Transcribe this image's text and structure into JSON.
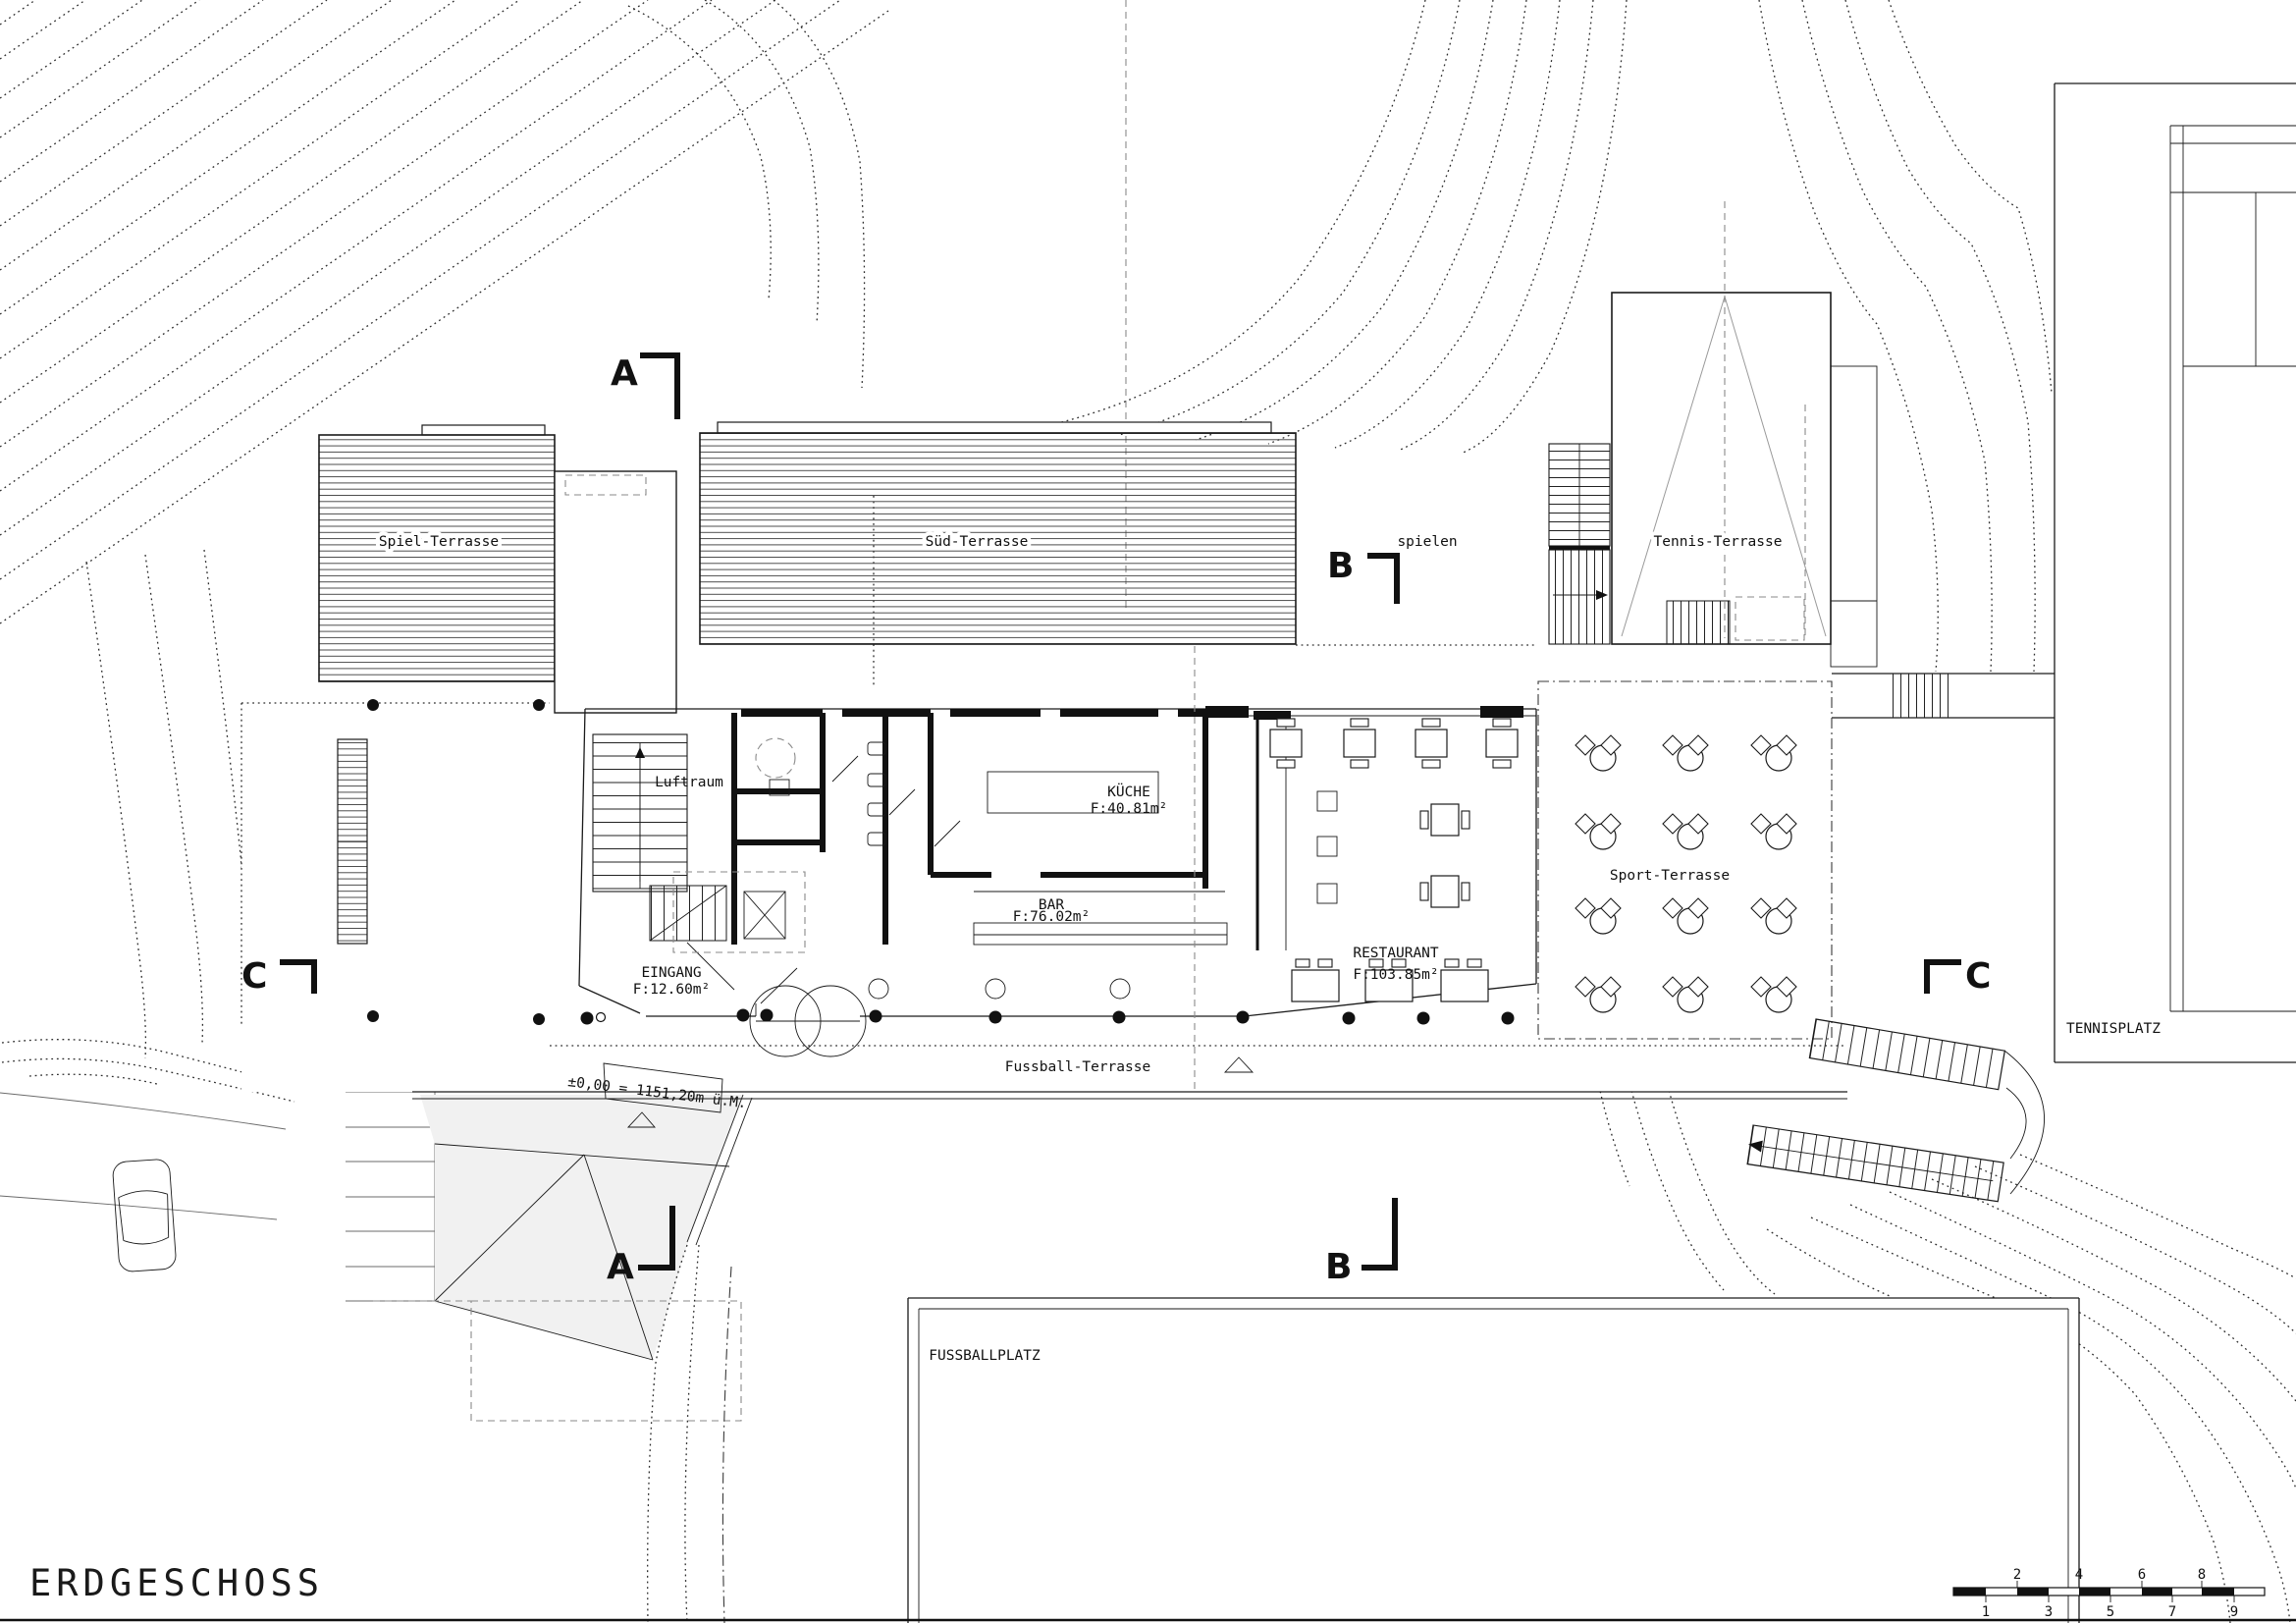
{
  "title": "ERDGESCHOSS",
  "colors": {
    "line": "#1a1a1a",
    "light_fill": "#f1f1f1",
    "hatch": "#3a3a3a"
  },
  "plan": {
    "areas": {
      "spiel_terrasse": "Spiel-Terrasse",
      "sued_terrasse": "Süd-Terrasse",
      "tennis_terrasse": "Tennis-Terrasse",
      "sport_terrasse": "Sport-Terrasse",
      "fussball_terrasse": "Fussball-Terrasse",
      "spielen": "spielen",
      "luftraum": "Luftraum",
      "fussballplatz": "FUSSBALLPLATZ",
      "tennisplatz": "TENNISPLATZ"
    },
    "rooms": {
      "kueche": {
        "name": "KÜCHE",
        "area": "F:40.81m²"
      },
      "bar": {
        "name": "BAR",
        "area": "F:76.02m²"
      },
      "restaurant": {
        "name": "RESTAURANT",
        "area": "F:103.85m²"
      },
      "eingang": {
        "name": "EINGANG",
        "area": "F:12.60m²"
      }
    },
    "elevation": "±0,00 = 1151,20m ü.M.",
    "section_markers": {
      "a": "A",
      "b": "B",
      "c": "C"
    },
    "scale_numbers": [
      "1",
      "2",
      "3",
      "4",
      "5",
      "6",
      "7",
      "8",
      "9"
    ]
  }
}
